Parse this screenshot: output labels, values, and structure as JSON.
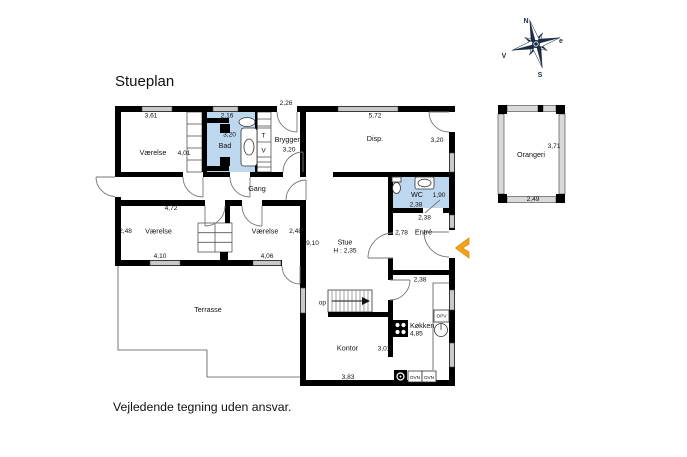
{
  "title": "Stueplan",
  "footer": "Vejledende tegning uden ansvar.",
  "colors": {
    "bath_blue": "#bdd7ee",
    "window_gray": "#c9c9c9",
    "glass_gray": "#d9d9d9",
    "compass_navy": "#1c2b45",
    "arrow_orange": "#f6a21c",
    "arrow_orange_dark": "#d98d06"
  },
  "compass": {
    "north": "N",
    "east": "e",
    "south": "S",
    "west": "V"
  },
  "rooms": {
    "v1": {
      "label": "Værelse",
      "dim_top": "3,61",
      "dim_right": "4,01"
    },
    "bad": {
      "label": "Bad",
      "dim_top": "2,16",
      "dim_side": "3,20"
    },
    "closet": {
      "top": "T",
      "bottom": "V"
    },
    "bryggers": {
      "label": "Bryggers",
      "dim_top": "2,26",
      "dim_side": "3,20"
    },
    "disp": {
      "label": "Disp.",
      "dim_top": "5,72",
      "dim_right": "3,20"
    },
    "gang": {
      "label": "Gang"
    },
    "v2": {
      "label": "Værelse",
      "dim_top": "4,72",
      "dim_left": "2,48",
      "dim_bottom": "4,10"
    },
    "v3": {
      "label": "Værelse",
      "dim_right": "2,48",
      "dim_bottom": "4,06"
    },
    "stue": {
      "label": "Stue",
      "ceiling": "H : 2,35",
      "dim_left": "9,10"
    },
    "wc": {
      "label": "WC",
      "dim_right": "1,90",
      "dim_door": "2,38",
      "dim_below": "2,38"
    },
    "entre": {
      "label": "Entré",
      "dim_left": "2,78",
      "dim_below": "2,38"
    },
    "stairs": {
      "label": "op"
    },
    "kontor": {
      "label": "Kontor",
      "dim_right": "3,01",
      "dim_bottom": "3,83"
    },
    "kitchen": {
      "label": "Køkken",
      "dim": "4,85",
      "opv": "OPV",
      "ovn_left": "OVN",
      "ovn_right": "OVN"
    },
    "terrasse": {
      "label": "Terrasse"
    },
    "orangeri": {
      "label": "Orangeri",
      "dim_right": "3,71",
      "dim_bottom": "2,49"
    }
  }
}
